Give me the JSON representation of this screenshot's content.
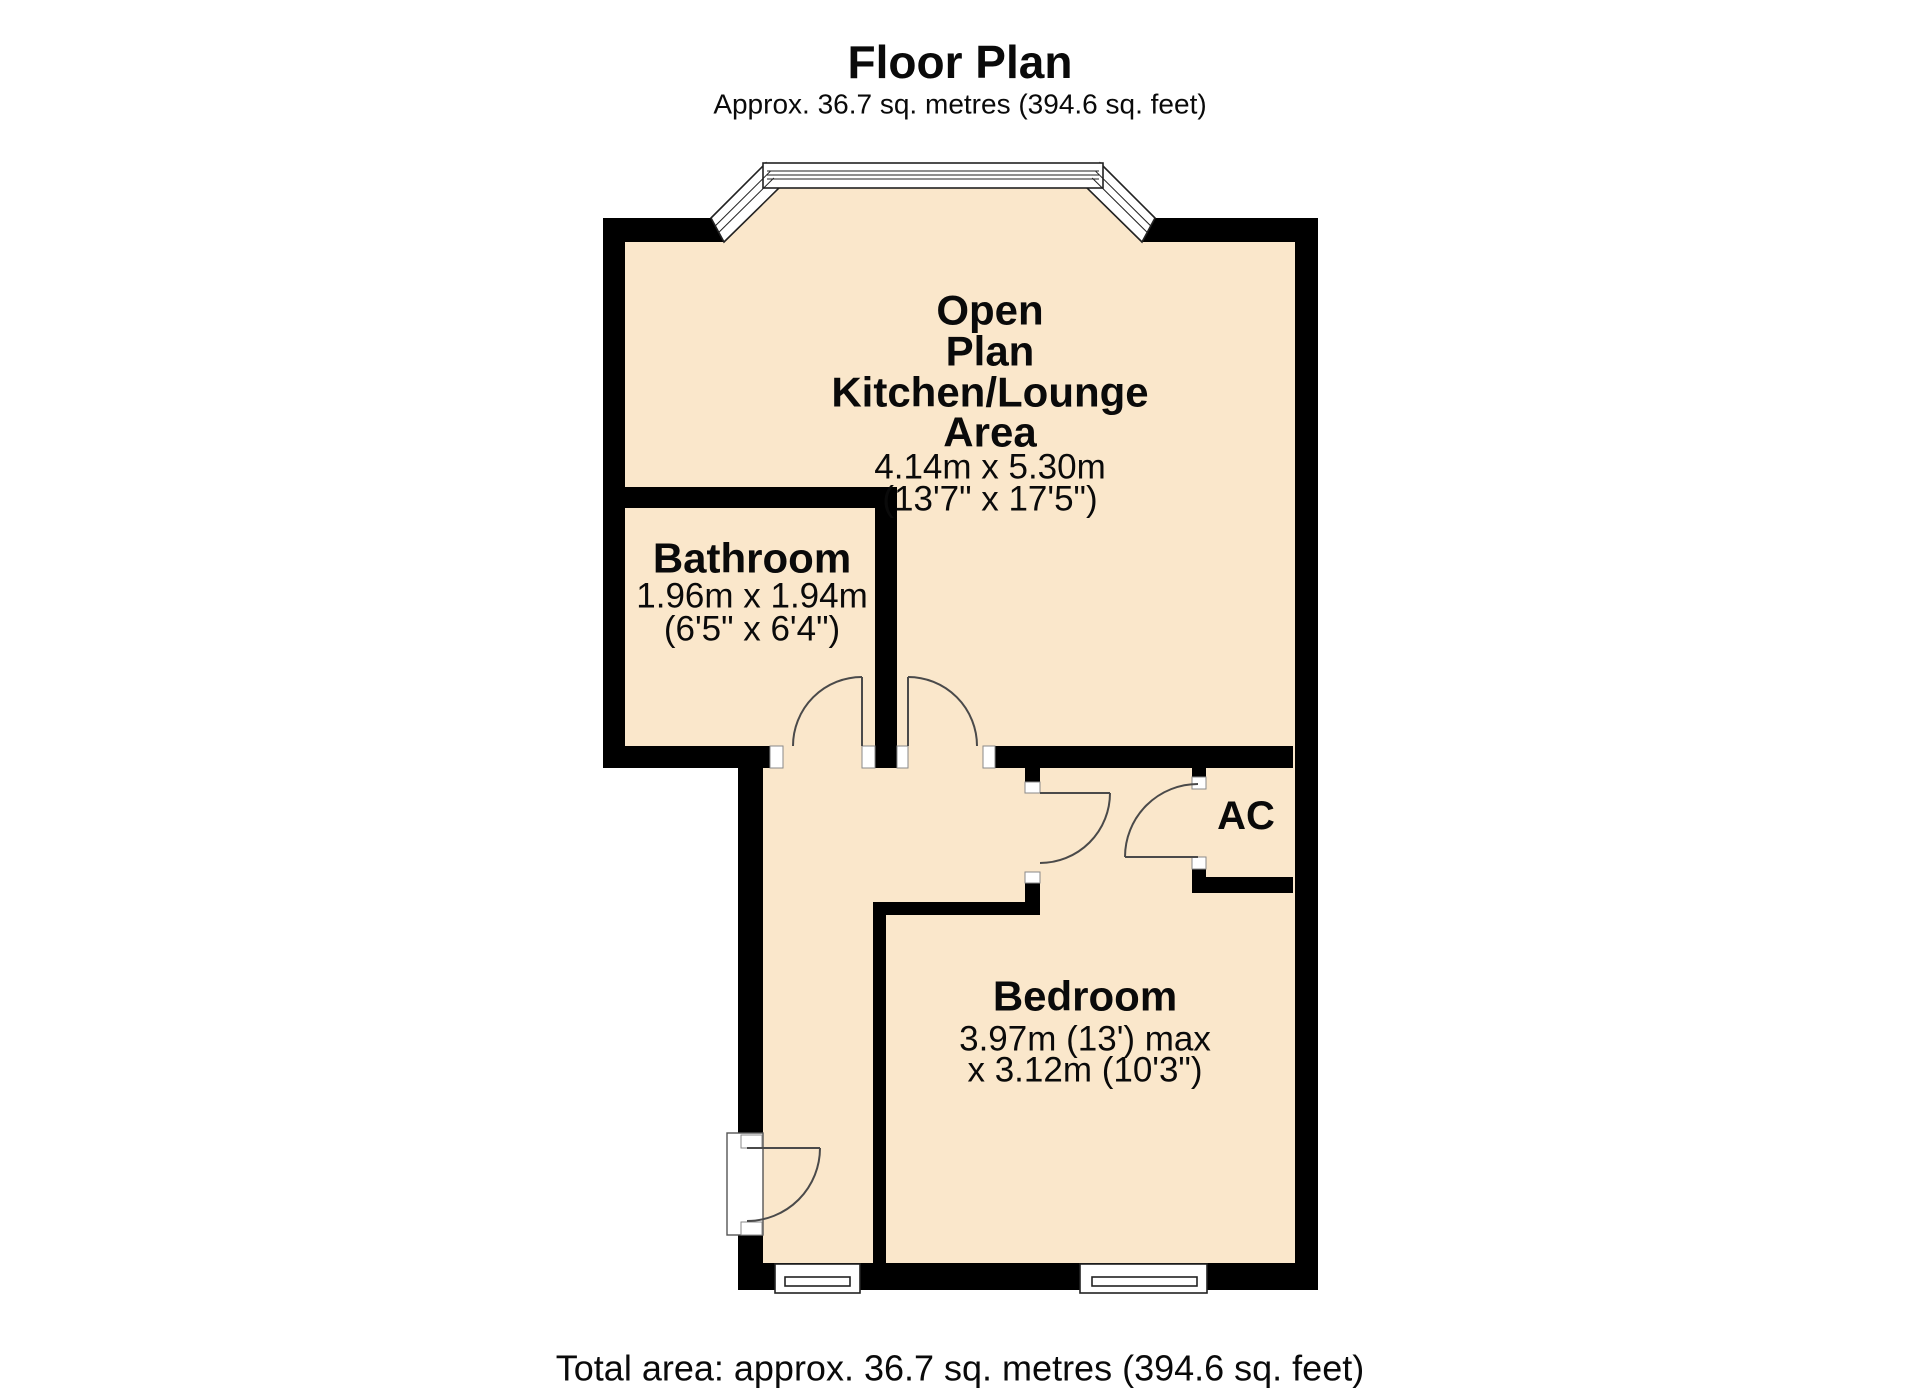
{
  "header": {
    "title": "Floor Plan",
    "subtitle": "Approx. 36.7 sq. metres (394.6 sq. feet)"
  },
  "rooms": {
    "open_plan": {
      "name_lines": [
        "Open",
        "Plan",
        "Kitchen/Lounge",
        "Area"
      ],
      "dims_metric": "4.14m x 5.30m",
      "dims_imperial": "(13'7\" x 17'5\")"
    },
    "bathroom": {
      "name": "Bathroom",
      "dims_metric": "1.96m x 1.94m",
      "dims_imperial": "(6'5\" x 6'4\")"
    },
    "bedroom": {
      "name": "Bedroom",
      "dims_line1": "3.97m (13') max",
      "dims_line2": "x 3.12m (10'3\")"
    },
    "ac_closet": {
      "name": "AC"
    }
  },
  "footer": {
    "total_area": "Total area: approx. 36.7 sq. metres (394.6 sq. feet)"
  },
  "colors": {
    "floor": "#fae7cb",
    "wall": "#000000",
    "background": "#ffffff",
    "line": "#4a4a4a"
  }
}
